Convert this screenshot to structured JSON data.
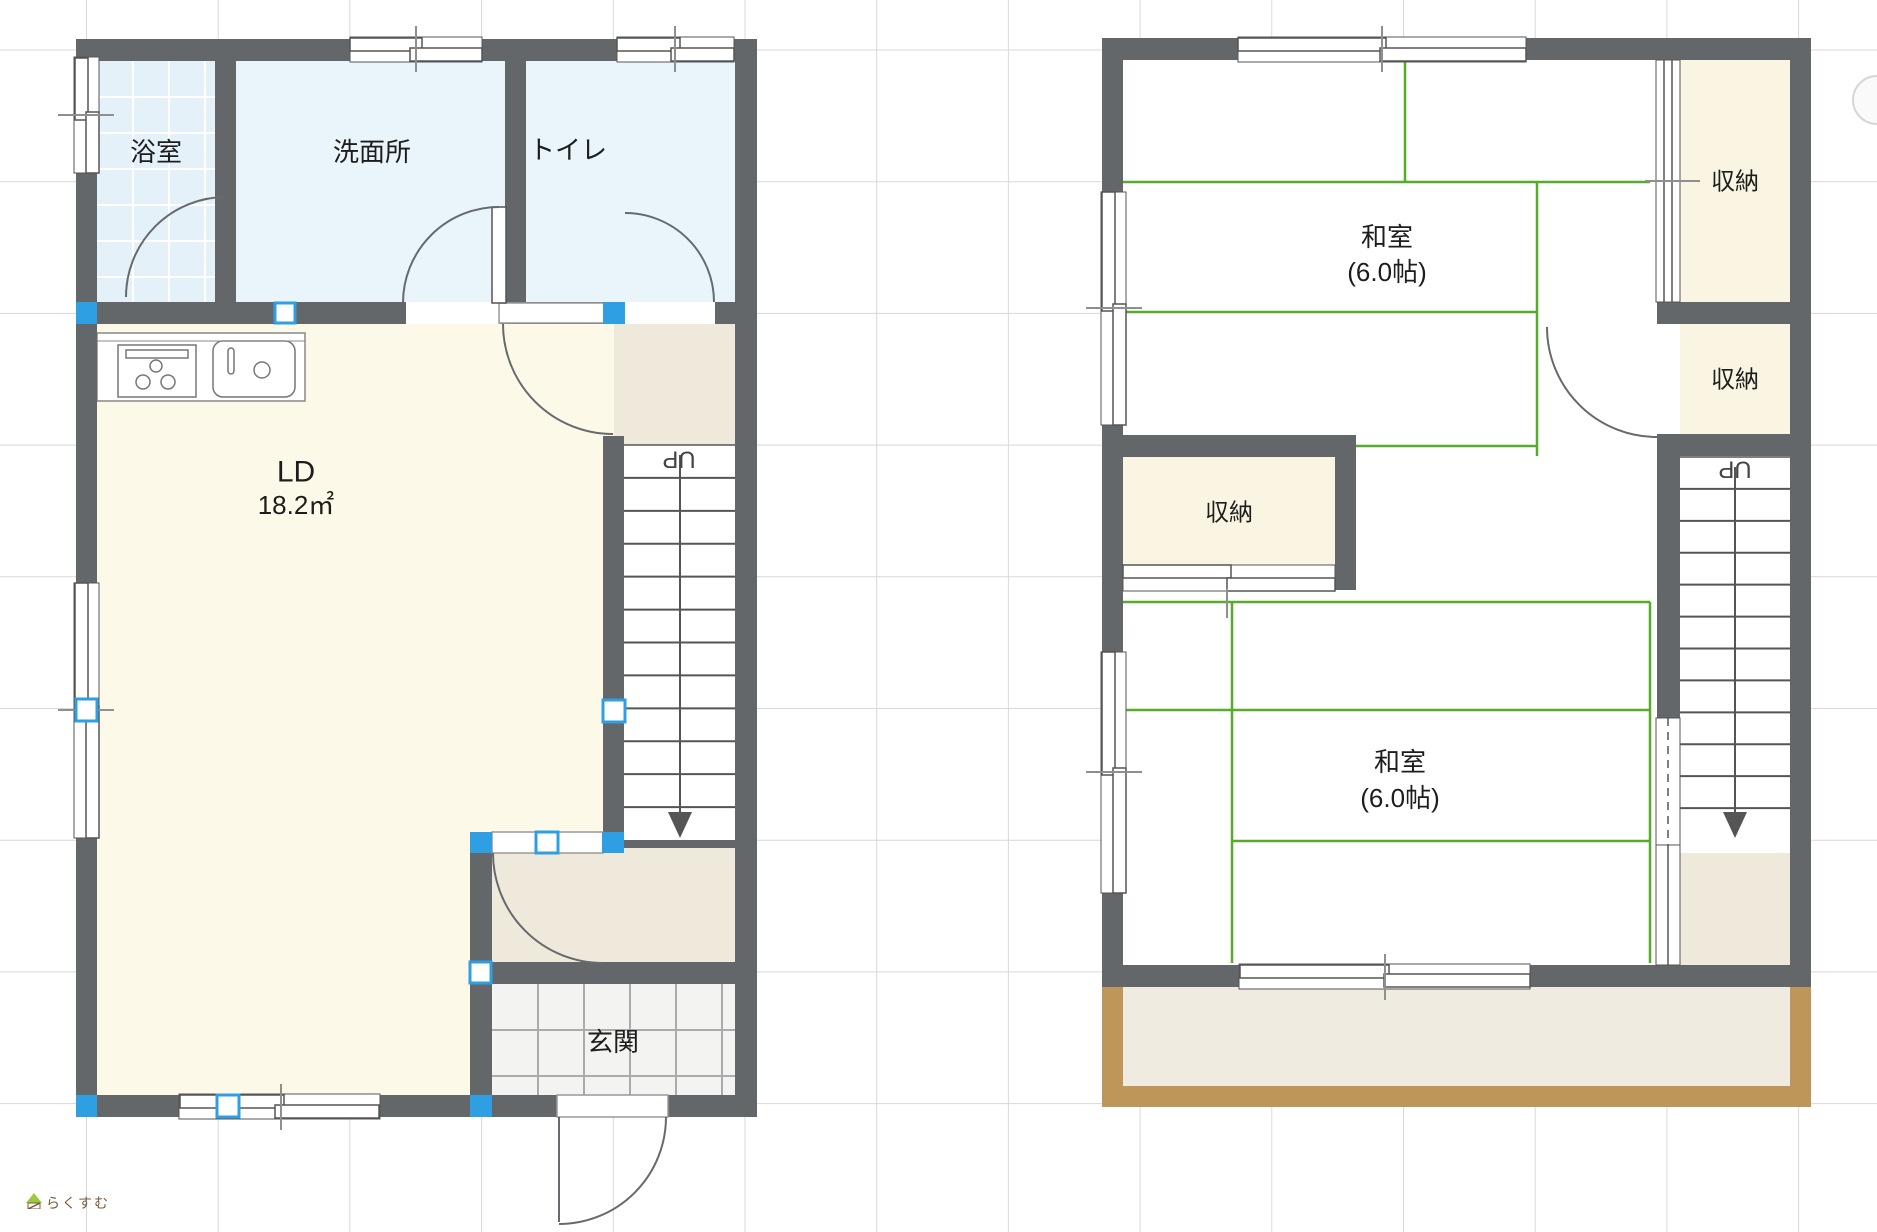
{
  "meta": {
    "w": 1877,
    "h": 1232
  },
  "colors": {
    "wall": "#63676a",
    "green": "#55ac2a",
    "blue": "#2f9fe3",
    "beige": "#efe9dc",
    "cream": "#fdf9e8",
    "closet": "#faf5e2",
    "bath": "#e4f1f9",
    "water": "#eaf5fb",
    "genkan": "#f3f3f1",
    "brown": "#bf9659",
    "balcony": "#f0ebe0",
    "grid": "#d8d8d8",
    "line": "#555555",
    "tick": "#8f8f8f",
    "text": "#1d1d1d",
    "door": "#666a6e"
  },
  "grid": {
    "vx0": 86.5,
    "vn": 14,
    "hy0": 50,
    "hn": 9,
    "step": 131.7
  },
  "bases": [
    {
      "name": "floor1-base",
      "x": 76,
      "y": 39,
      "w": 681,
      "h": 1078
    },
    {
      "name": "floor2-base",
      "x": 1102,
      "y": 38,
      "w": 709,
      "h": 949
    },
    {
      "name": "balcony-base",
      "x": 1102,
      "y": 987,
      "w": 709,
      "h": 120
    }
  ],
  "rooms": [
    {
      "name": "room-bathroom",
      "x": 97,
      "y": 61,
      "w": 118,
      "h": 241,
      "fill": "bath",
      "tile": {
        "step": 36,
        "color": "#ffffff",
        "lw": 2
      }
    },
    {
      "name": "room-washroom",
      "x": 236,
      "y": 61,
      "w": 269,
      "h": 241,
      "fill": "water"
    },
    {
      "name": "room-toilet",
      "x": 526,
      "y": 61,
      "w": 209,
      "h": 241,
      "fill": "water"
    },
    {
      "name": "room-living-dining",
      "x": 97,
      "y": 324,
      "w": 517,
      "h": 771,
      "fill": "cream"
    },
    {
      "name": "room-upper-landing",
      "x": 614,
      "y": 324,
      "w": 121,
      "h": 121,
      "fill": "beige"
    },
    {
      "name": "room-lower-hall",
      "x": 492,
      "y": 848,
      "w": 243,
      "h": 115,
      "fill": "beige"
    },
    {
      "name": "room-genkan",
      "x": 492,
      "y": 984,
      "w": 243,
      "h": 111,
      "fill": "genkan",
      "tile": {
        "step": 46,
        "color": "#ababab",
        "lw": 2
      }
    },
    {
      "name": "room-closet-1",
      "x": 1680,
      "y": 60,
      "w": 110,
      "h": 242,
      "fill": "closet"
    },
    {
      "name": "room-closet-2",
      "x": 1680,
      "y": 324,
      "w": 110,
      "h": 110,
      "fill": "closet"
    },
    {
      "name": "room-closet-3",
      "x": 1123,
      "y": 457,
      "w": 212,
      "h": 108,
      "fill": "closet"
    },
    {
      "name": "room-stair-bottom-2f",
      "x": 1680,
      "y": 853,
      "w": 110,
      "h": 112,
      "fill": "beige"
    },
    {
      "name": "balcony-floor",
      "x": 1123,
      "y": 987,
      "w": 667,
      "h": 99,
      "fill": "balcony"
    },
    {
      "name": "balcony-edge-left",
      "x": 1102,
      "y": 987,
      "w": 21,
      "h": 120,
      "fill": "brown"
    },
    {
      "name": "balcony-edge-right",
      "x": 1790,
      "y": 987,
      "w": 21,
      "h": 120,
      "fill": "brown"
    },
    {
      "name": "balcony-edge-bottom",
      "x": 1102,
      "y": 1086,
      "w": 709,
      "h": 21,
      "fill": "brown"
    }
  ],
  "tatami": [
    [
      1123,
      182,
      1650,
      182
    ],
    [
      1405,
      60,
      1405,
      182
    ],
    [
      1537,
      182,
      1537,
      456
    ],
    [
      1123,
      312,
      1537,
      312
    ],
    [
      1356,
      446,
      1537,
      446
    ],
    [
      1123,
      602,
      1650,
      602
    ],
    [
      1650,
      602,
      1650,
      963
    ],
    [
      1123,
      710,
      1650,
      710
    ],
    [
      1232,
      841,
      1650,
      841
    ],
    [
      1232,
      602,
      1232,
      963
    ]
  ],
  "stairs": [
    {
      "name": "stairs-1f",
      "x": 624,
      "y": 445,
      "w": 111,
      "h": 395,
      "steps": 11,
      "shaft": 680,
      "up": {
        "x": 679,
        "y": 459
      }
    },
    {
      "name": "stairs-2f",
      "x": 1680,
      "y": 457,
      "w": 110,
      "h": 383,
      "steps": 11,
      "shaft": 1735,
      "up": {
        "x": 1735,
        "y": 469
      }
    }
  ],
  "up_label": "UP",
  "kitchen": {
    "name": "kitchen-counter",
    "rects": [
      {
        "x": 97,
        "y": 333,
        "w": 208,
        "h": 68,
        "s": "#888"
      },
      {
        "x": 118,
        "y": 345,
        "w": 78,
        "h": 52,
        "s": "#777"
      },
      {
        "x": 126,
        "y": 350,
        "w": 62,
        "h": 8,
        "s": "#777"
      },
      {
        "x": 213,
        "y": 341,
        "w": 82,
        "h": 56,
        "s": "#777",
        "rx": 10
      },
      {
        "x": 228,
        "y": 348,
        "w": 6,
        "h": 26,
        "s": "#777",
        "rx": 3
      }
    ],
    "lines": [
      [
        97,
        341,
        305,
        341
      ]
    ],
    "circles": [
      [
        143,
        382,
        7
      ],
      [
        168,
        382,
        7
      ],
      [
        156,
        366,
        6
      ],
      [
        262,
        370,
        8
      ]
    ]
  },
  "walls": [
    {
      "name": "wall-1f-top",
      "x": 76,
      "y": 39,
      "w": 681,
      "h": 22
    },
    {
      "name": "wall-1f-left",
      "x": 76,
      "y": 39,
      "w": 21,
      "h": 1078
    },
    {
      "name": "wall-1f-right",
      "x": 735,
      "y": 39,
      "w": 22,
      "h": 1078
    },
    {
      "name": "wall-1f-bottom",
      "x": 76,
      "y": 1095,
      "w": 681,
      "h": 22
    },
    {
      "name": "wall-1f-bathrow",
      "x": 76,
      "y": 302,
      "w": 659,
      "h": 22
    },
    {
      "name": "wall-bath-wash",
      "x": 215,
      "y": 61,
      "w": 21,
      "h": 241
    },
    {
      "name": "wall-wash-toilet",
      "x": 505,
      "y": 61,
      "w": 21,
      "h": 241
    },
    {
      "name": "wall-ld-stairs",
      "x": 603,
      "y": 436,
      "w": 21,
      "h": 417
    },
    {
      "name": "wall-hall-left",
      "x": 470,
      "y": 832,
      "w": 22,
      "h": 285
    },
    {
      "name": "wall-hall-genkan",
      "x": 470,
      "y": 962,
      "w": 286,
      "h": 22
    },
    {
      "name": "wall-stair-foot",
      "x": 613,
      "y": 840,
      "w": 143,
      "h": 8
    },
    {
      "name": "wall-2f-top",
      "x": 1102,
      "y": 38,
      "w": 709,
      "h": 22
    },
    {
      "name": "wall-2f-left",
      "x": 1102,
      "y": 38,
      "w": 21,
      "h": 949
    },
    {
      "name": "wall-2f-right",
      "x": 1790,
      "y": 38,
      "w": 21,
      "h": 949
    },
    {
      "name": "wall-2f-bottom",
      "x": 1102,
      "y": 965,
      "w": 709,
      "h": 22
    },
    {
      "name": "wall-closet1-bottom",
      "x": 1657,
      "y": 302,
      "w": 133,
      "h": 22
    },
    {
      "name": "wall-closet2-bottom",
      "x": 1657,
      "y": 434,
      "w": 133,
      "h": 22
    },
    {
      "name": "wall-closet3-top",
      "x": 1102,
      "y": 435,
      "w": 254,
      "h": 22
    },
    {
      "name": "wall-closet3-right",
      "x": 1335,
      "y": 435,
      "w": 21,
      "h": 155
    },
    {
      "name": "wall-2f-stair-left",
      "x": 1657,
      "y": 456,
      "w": 23,
      "h": 262
    }
  ],
  "windows": [
    {
      "name": "window-top-wash",
      "o": [
        350,
        37,
        132,
        25
      ],
      "s": [
        [
          350,
          38,
          72,
          13
        ],
        [
          410,
          48,
          72,
          13
        ]
      ],
      "tick": [
        416,
        26,
        416,
        72
      ]
    },
    {
      "name": "window-top-toilet",
      "o": [
        617,
        37,
        117,
        25
      ],
      "s": [
        [
          617,
          38,
          63,
          13
        ],
        [
          671,
          48,
          63,
          13
        ]
      ],
      "tick": [
        675,
        26,
        675,
        72
      ]
    },
    {
      "name": "window-left-bath",
      "o": [
        74,
        57,
        25,
        116
      ],
      "s": [
        [
          75,
          58,
          13,
          62
        ],
        [
          86,
          112,
          13,
          61
        ]
      ],
      "tick": [
        58,
        115,
        114,
        115
      ]
    },
    {
      "name": "window-left-ld",
      "o": [
        74,
        583,
        25,
        255
      ],
      "s": [
        [
          75,
          583,
          13,
          131
        ],
        [
          86,
          706,
          13,
          132
        ]
      ],
      "tick": [
        58,
        710,
        114,
        710
      ]
    },
    {
      "name": "window-bottom-ld",
      "o": [
        179,
        1094,
        201,
        25
      ],
      "s": [
        [
          180,
          1095,
          104,
          13
        ],
        [
          275,
          1105,
          104,
          13
        ]
      ],
      "tick": [
        281,
        1084,
        281,
        1130
      ]
    },
    {
      "name": "window-2f-top",
      "o": [
        1238,
        37,
        288,
        25
      ],
      "s": [
        [
          1238,
          38,
          148,
          13
        ],
        [
          1380,
          48,
          146,
          13
        ]
      ],
      "tick": [
        1382,
        26,
        1382,
        72
      ]
    },
    {
      "name": "window-2f-left-a",
      "o": [
        1101,
        192,
        25,
        233
      ],
      "s": [
        [
          1102,
          192,
          13,
          119
        ],
        [
          1113,
          304,
          13,
          121
        ]
      ],
      "tick": [
        1086,
        308,
        1142,
        308
      ]
    },
    {
      "name": "window-2f-left-b",
      "o": [
        1101,
        652,
        25,
        241
      ],
      "s": [
        [
          1102,
          652,
          13,
          123
        ],
        [
          1113,
          768,
          13,
          125
        ]
      ],
      "tick": [
        1086,
        772,
        1142,
        772
      ]
    },
    {
      "name": "window-2f-bottom",
      "o": [
        1239,
        964,
        291,
        25
      ],
      "s": [
        [
          1240,
          965,
          149,
          13
        ],
        [
          1384,
          974,
          146,
          13
        ]
      ],
      "tick": [
        1385,
        954,
        1385,
        1000
      ]
    }
  ],
  "sliders": [
    {
      "name": "sliding-door-closet1",
      "o": [
        1656,
        60,
        24,
        242
      ],
      "lines": [
        [
          1664,
          60,
          1664,
          302
        ],
        [
          1672,
          60,
          1672,
          302
        ]
      ],
      "tick": [
        1645,
        181,
        1700,
        181
      ]
    },
    {
      "name": "sliding-door-closet3",
      "o": [
        1123,
        565,
        212,
        26
      ],
      "s": [
        [
          1123,
          565,
          108,
          13
        ],
        [
          1227,
          578,
          108,
          13
        ]
      ],
      "tick": [
        1227,
        588,
        1227,
        618
      ]
    },
    {
      "name": "sliding-door-stair-lower",
      "o": [
        1656,
        845,
        24,
        120
      ],
      "lines": [
        [
          1668,
          845,
          1668,
          965
        ]
      ]
    },
    {
      "name": "sliding-door-stair-upper",
      "o": [
        1656,
        718,
        24,
        127
      ],
      "lines": [
        [
          1668,
          718,
          1668,
          845
        ]
      ],
      "dash": true
    }
  ],
  "openings": [
    {
      "name": "opening-washroom-door",
      "x": 406,
      "y": 302,
      "w": 94,
      "h": 22
    },
    {
      "name": "opening-toilet-door",
      "x": 625,
      "y": 302,
      "w": 90,
      "h": 22
    },
    {
      "name": "opening-closet2-door",
      "x": 1657,
      "y": 324,
      "w": 23,
      "h": 110
    }
  ],
  "openings_bordered": [
    {
      "name": "door-leaf-ld-hall",
      "x": 499,
      "y": 303,
      "w": 115,
      "h": 20
    },
    {
      "name": "opening-ld-lower-hall",
      "x": 492,
      "y": 832,
      "w": 111,
      "h": 21
    },
    {
      "name": "opening-entrance",
      "x": 557,
      "y": 1095,
      "w": 111,
      "h": 22
    }
  ],
  "leaves": [
    {
      "name": "door-leaf-washroom",
      "type": "rect",
      "x": 492,
      "y": 207,
      "w": 14,
      "h": 96
    },
    {
      "name": "door-leaf-entrance",
      "type": "line",
      "x1": 559,
      "y1": 1117,
      "x2": 559,
      "y2": 1222
    }
  ],
  "arcs": [
    {
      "name": "door-arc-bathroom",
      "d": "M 126 297 A 100 100 0 0 1 226 197"
    },
    {
      "name": "door-arc-washroom",
      "d": "M 403 303 A 96 96 0 0 1 499 207"
    },
    {
      "name": "door-arc-toilet",
      "d": "M 714 302 A 89 89 0 0 0 625 213"
    },
    {
      "name": "door-arc-ld-hall",
      "d": "M 503 324 A 110 110 0 0 0 613 434"
    },
    {
      "name": "door-arc-lower-hall",
      "d": "M 493 853 A 110 110 0 0 0 603 963"
    },
    {
      "name": "door-arc-entrance",
      "d": "M 666 1117 A 107 107 0 0 1 559 1224"
    },
    {
      "name": "door-arc-closet2",
      "d": "M 1547 327 A 110 110 0 0 0 1657 437"
    }
  ],
  "handles": {
    "filled": [
      [
        76,
        302,
        21,
        22
      ],
      [
        603,
        302,
        22,
        22
      ],
      [
        76,
        1095,
        21,
        22
      ],
      [
        470,
        1095,
        22,
        22
      ],
      [
        470,
        832,
        22,
        21
      ],
      [
        602,
        832,
        22,
        21
      ]
    ],
    "hollow": [
      [
        275,
        303,
        20,
        20
      ],
      [
        603,
        700,
        22,
        22
      ],
      [
        76,
        699,
        21,
        22
      ],
      [
        536,
        832,
        22,
        21
      ],
      [
        470,
        962,
        21,
        21
      ],
      [
        217,
        1095,
        22,
        22
      ]
    ]
  },
  "labels": [
    {
      "name": "label-bathroom",
      "t": "浴室",
      "x": 156,
      "y": 152,
      "s": 26
    },
    {
      "name": "label-washroom",
      "t": "洗面所",
      "x": 372,
      "y": 152,
      "s": 26
    },
    {
      "name": "label-toilet",
      "t": "トイレ",
      "x": 568,
      "y": 150,
      "s": 26
    },
    {
      "name": "label-ld",
      "t": "LD",
      "x": 296,
      "y": 472,
      "s": 30
    },
    {
      "name": "label-ld-area",
      "t": "18.2㎡",
      "x": 296,
      "y": 505,
      "s": 26
    },
    {
      "name": "label-genkan",
      "t": "玄関",
      "x": 613,
      "y": 1042,
      "s": 26
    },
    {
      "name": "label-washitsu-1",
      "t": "和室",
      "x": 1387,
      "y": 237,
      "s": 26
    },
    {
      "name": "label-washitsu-1-size",
      "t": "(6.0帖)",
      "x": 1387,
      "y": 272,
      "s": 26
    },
    {
      "name": "label-washitsu-2",
      "t": "和室",
      "x": 1400,
      "y": 762,
      "s": 26
    },
    {
      "name": "label-washitsu-2-size",
      "t": "(6.0帖)",
      "x": 1400,
      "y": 798,
      "s": 26
    },
    {
      "name": "label-closet-1",
      "t": "収納",
      "x": 1735,
      "y": 182,
      "s": 24
    },
    {
      "name": "label-closet-2",
      "t": "収納",
      "x": 1735,
      "y": 380,
      "s": 24
    },
    {
      "name": "label-closet-3",
      "t": "収納",
      "x": 1229,
      "y": 513,
      "s": 24
    }
  ],
  "fab": {
    "name": "floating-button",
    "cx": 1877,
    "cy": 100,
    "r": 24
  },
  "logo": {
    "text": "らくすむ"
  }
}
